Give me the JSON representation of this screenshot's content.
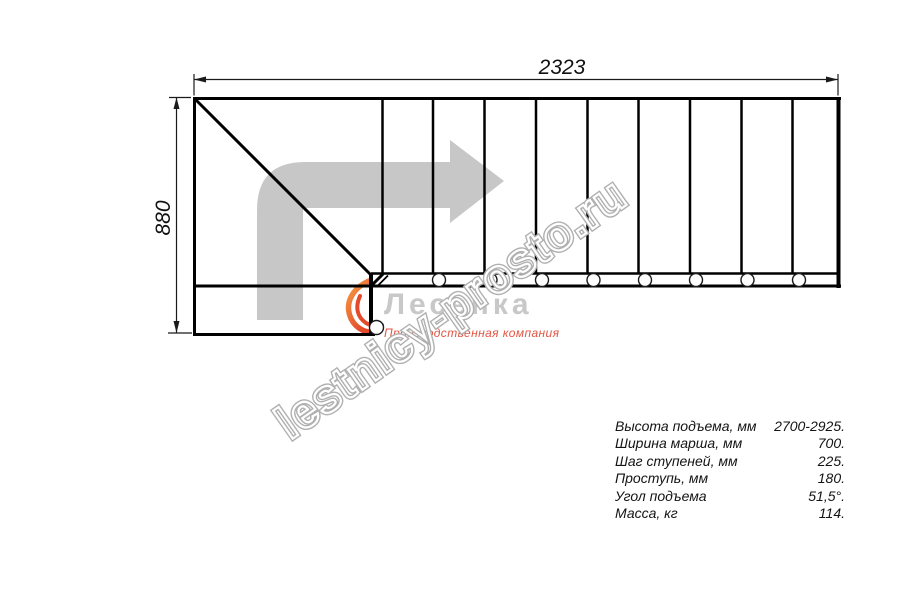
{
  "dimensions": {
    "width_mm": "2323",
    "height_mm": "880"
  },
  "watermark": {
    "text": "lestnicy-prosto.ru"
  },
  "logo": {
    "name": "Лесенка",
    "tagline": "Производственная компания"
  },
  "specs": {
    "rows": [
      {
        "label": "Высота подъема, мм",
        "value": "2700-2925."
      },
      {
        "label": "Ширина марша, мм",
        "value": "700."
      },
      {
        "label": "Шаг ступеней, мм",
        "value": "225."
      },
      {
        "label": "Проступь, мм",
        "value": "180."
      },
      {
        "label": "Угол подъема",
        "value": "51,5°."
      },
      {
        "label": "Масса, кг",
        "value": "114."
      }
    ]
  },
  "colors": {
    "drawing_line": "#000000",
    "dimension_line": "#1a1a1a",
    "direction_arrow_gray": "#c7c7c7",
    "watermark_gray": "#b0b0b0",
    "logo_name_gray": "#c8c8c8",
    "logo_tagline_red": "#e25544",
    "flame_orange": "#f59b43",
    "flame_red": "#e34a2c"
  }
}
